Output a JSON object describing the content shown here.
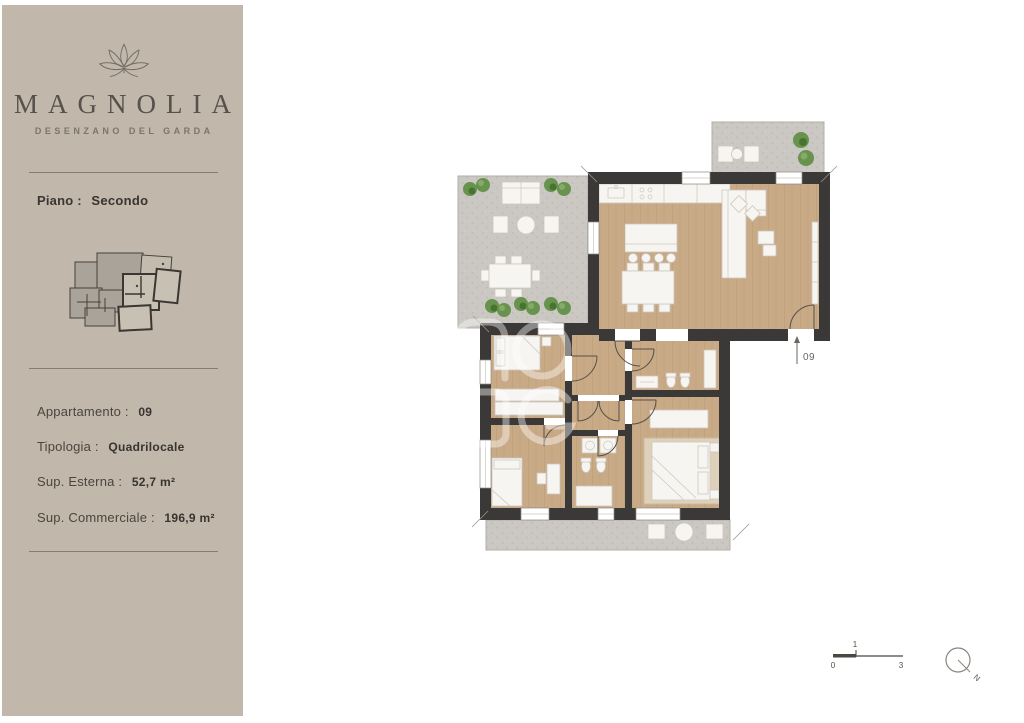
{
  "brand": {
    "name": "MAGNOLIA",
    "subtitle": "DESENZANO DEL GARDA"
  },
  "floor": {
    "label": "Piano :",
    "value": "Secondo"
  },
  "details": {
    "rows": [
      {
        "label": "Appartamento :",
        "value": "09"
      },
      {
        "label": "Tipologia :",
        "value": "Quadrilocale"
      },
      {
        "label": "Sup. Esterna :",
        "value": "52,7 m²"
      },
      {
        "label": "Sup. Commerciale :",
        "value": "196,9 m²"
      }
    ]
  },
  "plan": {
    "unit_label": "09"
  },
  "scale_bar": {
    "zero": "0",
    "one": "1",
    "three": "3"
  },
  "compass": {
    "north": "N"
  },
  "colors": {
    "sidebar_bg": "#c1b7ab",
    "wall": "#3a3937",
    "wood_floor": "#c9aa86",
    "stone": "#cbc7c2",
    "plant_green": "#67934f",
    "text_dark": "#3a3631",
    "text_muted": "#6f6961"
  }
}
